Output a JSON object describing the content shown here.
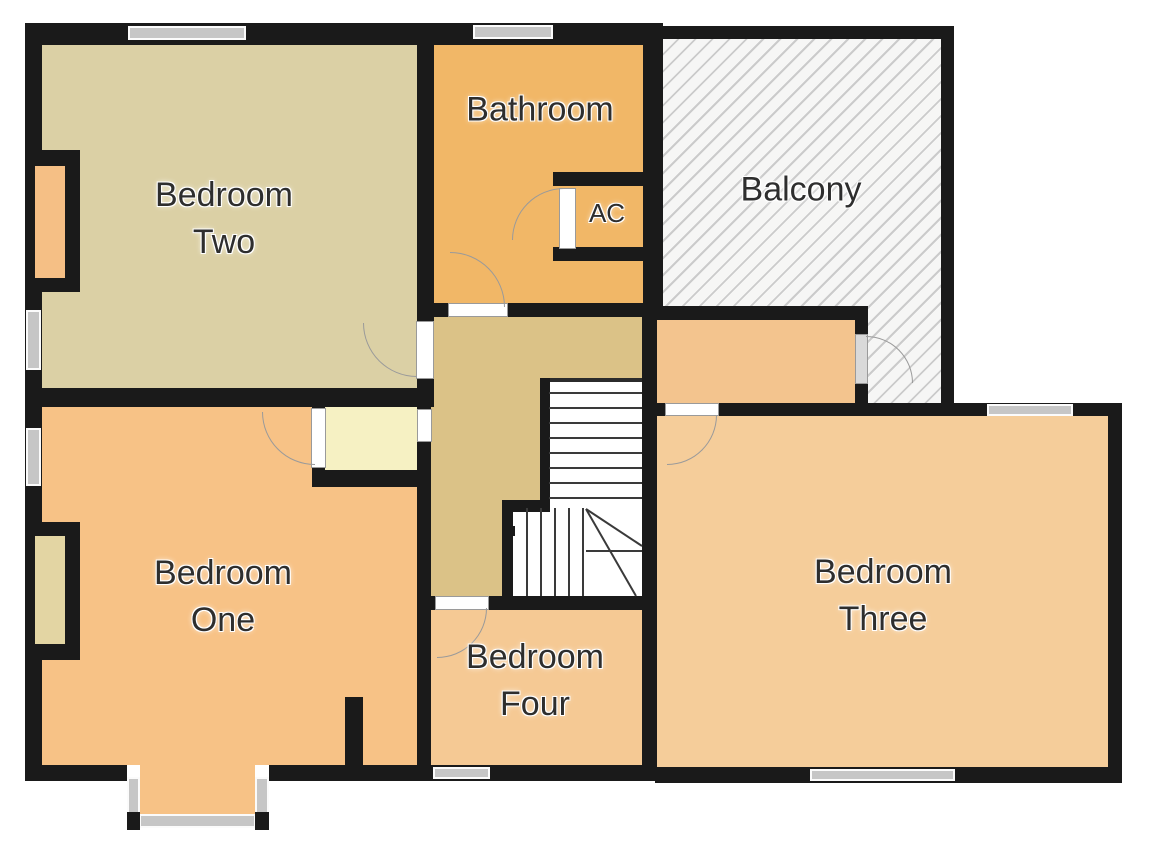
{
  "plan_title": "First floor plan",
  "rooms": [
    {
      "id": "bedroom-two",
      "label_lines": [
        "Bedroom",
        "Two"
      ],
      "fill": "#DBD0A5"
    },
    {
      "id": "bathroom",
      "label_lines": [
        "Bathroom"
      ],
      "fill": "#F1B767"
    },
    {
      "id": "ac-closet",
      "label_lines": [
        "AC"
      ],
      "fill": "#F1B767"
    },
    {
      "id": "balcony",
      "label_lines": [
        "Balcony"
      ],
      "fill": "#F6F6F5",
      "hatch_line_color": "#CBCBCB"
    },
    {
      "id": "bedroom-one",
      "label_lines": [
        "Bedroom",
        "One"
      ],
      "fill": "#F7C286"
    },
    {
      "id": "bedroom-four",
      "label_lines": [
        "Bedroom",
        "Four"
      ],
      "fill": "#F5C994"
    },
    {
      "id": "bedroom-three",
      "label_lines": [
        "Bedroom",
        "Three"
      ],
      "fill": "#F5CD9A"
    }
  ],
  "hall": {
    "fill": "#DBC287"
  },
  "closet_lobby": {
    "fill": "#F6F1C3"
  },
  "niches": {
    "bedroom_two_fill": "#F5BF85",
    "bedroom_one_fill": "#E3D5A3"
  },
  "colors": {
    "wall": "#1A1A1A",
    "window": "#C6C6C6",
    "door": "#9A9A9A",
    "stair_tread": "#333333",
    "label_text": "#2E2E2E",
    "background": "#FFFFFF"
  },
  "doors": [
    "bedroom-two-door",
    "bathroom-door",
    "ac-closet-door",
    "bedroom-one-closet-door",
    "bedroom-four-door",
    "bedroom-three-door",
    "balcony-door"
  ],
  "windows": [
    "bedroom-two-top-window",
    "bathroom-top-window",
    "bedroom-two-left-window",
    "bedroom-one-left-window",
    "bay-left-window",
    "bay-bottom-window",
    "bay-right-window",
    "bedroom-four-bottom-window",
    "bedroom-three-bottom-window",
    "bedroom-three-top-window"
  ],
  "features": [
    "staircase-with-winders",
    "bay-window",
    "chimney-recess-bedroom-two",
    "chimney-recess-bedroom-one"
  ]
}
